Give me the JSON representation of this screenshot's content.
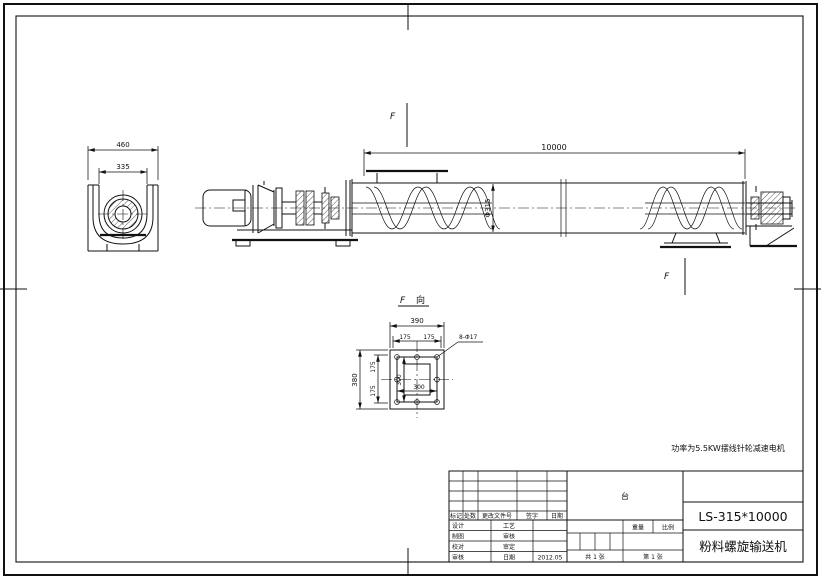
{
  "drawing_number": "LS-315*10000",
  "drawing_title": "粉料螺旋输送机",
  "note": "功率为5.5KW摆线针轮减速电机",
  "section": {
    "letter": "F",
    "direction_label": "向"
  },
  "dims": {
    "trough_width": "460",
    "trough_inner_width": "335",
    "conveyor_length": "10000",
    "screw_diameter": "Φ315",
    "flange_width": "390",
    "flange_height": "380",
    "hole_pitch": "175",
    "opening_size": "300",
    "bolt_holes": "8-Φ17"
  },
  "title_block": {
    "rev_headers": [
      "标记",
      "处数",
      "更改文件号",
      "签字",
      "日期"
    ],
    "sign_left": [
      "设计",
      "制图",
      "校对",
      "审核"
    ],
    "sign_mid": [
      "工艺",
      "审核",
      "审定",
      "日期"
    ],
    "date": "2012.05",
    "quantity_unit": "台",
    "weight_label": "重量",
    "scale_label": "比例",
    "sheet_total": "共 1 张",
    "sheet_number": "第 1 张"
  }
}
